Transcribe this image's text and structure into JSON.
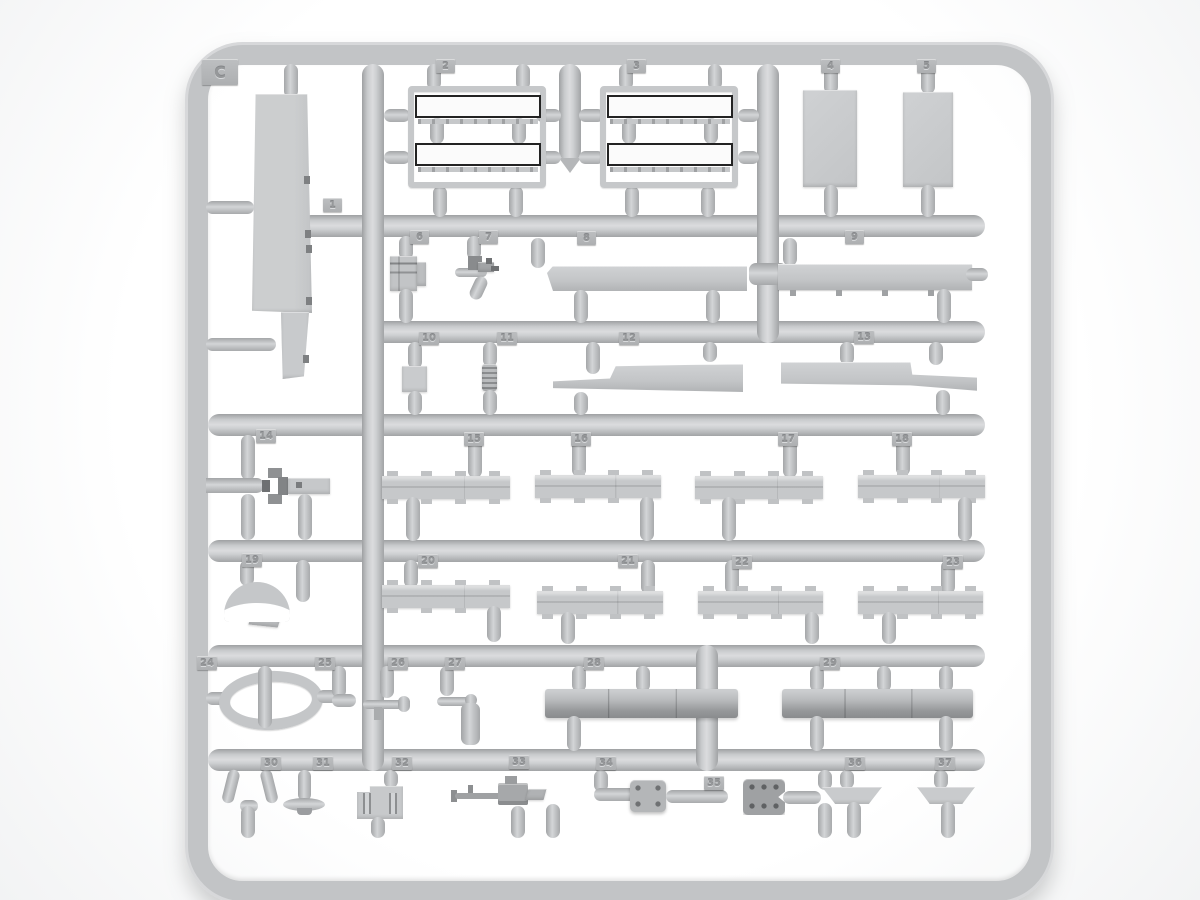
{
  "sprue": {
    "plate_letter": "C",
    "description": "Gray injection-molded model kit parts sprue, runner C, numbered parts 1-37",
    "tags": [
      "1",
      "2",
      "3",
      "4",
      "5",
      "6",
      "7",
      "8",
      "9",
      "10",
      "11",
      "12",
      "13",
      "14",
      "15",
      "16",
      "17",
      "18",
      "19",
      "20",
      "21",
      "22",
      "23",
      "24",
      "25",
      "26",
      "27",
      "28",
      "29",
      "30",
      "31",
      "32",
      "33",
      "34",
      "35",
      "36",
      "37"
    ]
  },
  "colors": {
    "background": "#ffffff",
    "plastic": "#c6c8ca",
    "plastic_dark": "#95979a",
    "tag_plate": "#b4b6b8",
    "part_face_highlight": "#fbfbfb",
    "part_edge_dark": "#232323"
  }
}
